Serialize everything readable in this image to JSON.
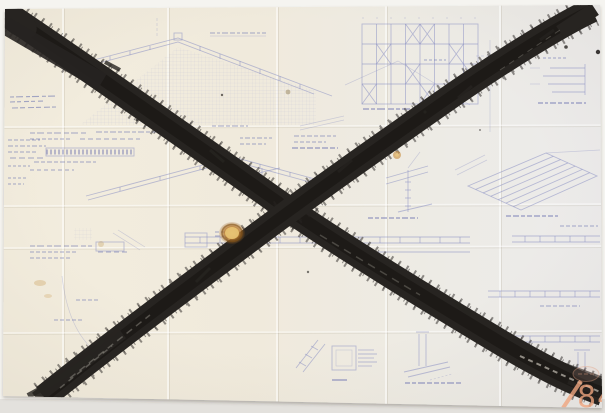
{
  "artwork": {
    "sheet_number": "84",
    "colors": {
      "photo_bg": "#f5f4f0",
      "photo_bg_bottom": "#e3e1dd",
      "paper_warm": "#f2ecdf",
      "paper_cool": "#ecebe9",
      "ink_blue": "#8a90c2",
      "ink_dark": "#6d74b0",
      "brush_black": "#272421",
      "stain_amber": "#bf8030",
      "number_salmon": "#efa57f"
    }
  }
}
